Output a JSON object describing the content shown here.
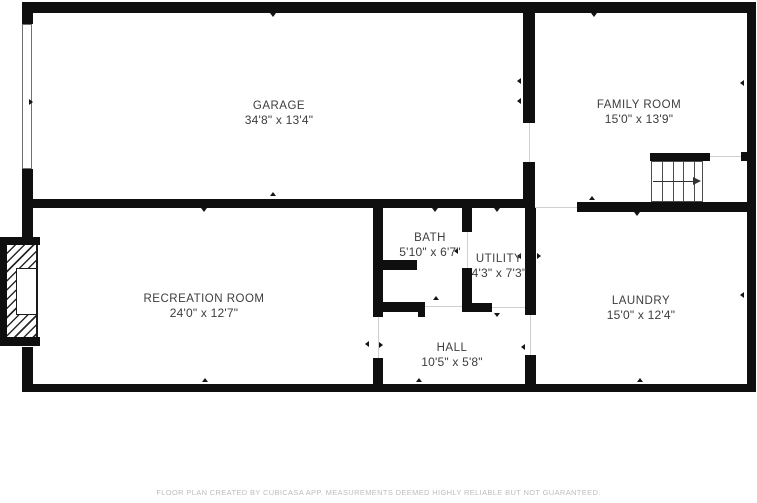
{
  "plan": {
    "type": "floor-plan",
    "level": "basement-garage"
  },
  "rooms": [
    {
      "id": "garage",
      "name": "GARAGE",
      "dims": "34'8\" x 13'4\""
    },
    {
      "id": "family-room",
      "name": "FAMILY ROOM",
      "dims": "15'0\" x 13'9\""
    },
    {
      "id": "recreation-room",
      "name": "RECREATION ROOM",
      "dims": "24'0\" x 12'7\""
    },
    {
      "id": "bath",
      "name": "BATH",
      "dims": "5'10\" x 6'7\""
    },
    {
      "id": "utility",
      "name": "UTILITY",
      "dims": "4'3\" x 7'3\""
    },
    {
      "id": "hall",
      "name": "HALL",
      "dims": "10'5\" x 5'8\""
    },
    {
      "id": "laundry",
      "name": "LAUNDRY",
      "dims": "15'0\" x 12'4\""
    }
  ],
  "features": {
    "stairs_direction": "right",
    "fireplace": "recreation-room-left-wall",
    "garage_door": "left-exterior-wall"
  },
  "footer": {
    "disclaimer": "FLOOR PLAN CREATED BY CUBICASA APP. MEASUREMENTS DEEMED HIGHLY RELIABLE BUT NOT GUARANTEED."
  },
  "colors": {
    "wall": "#0f0f0f",
    "room_text": "#3d3d3d",
    "footer_text": "#bdbdbd",
    "background": "#ffffff"
  }
}
